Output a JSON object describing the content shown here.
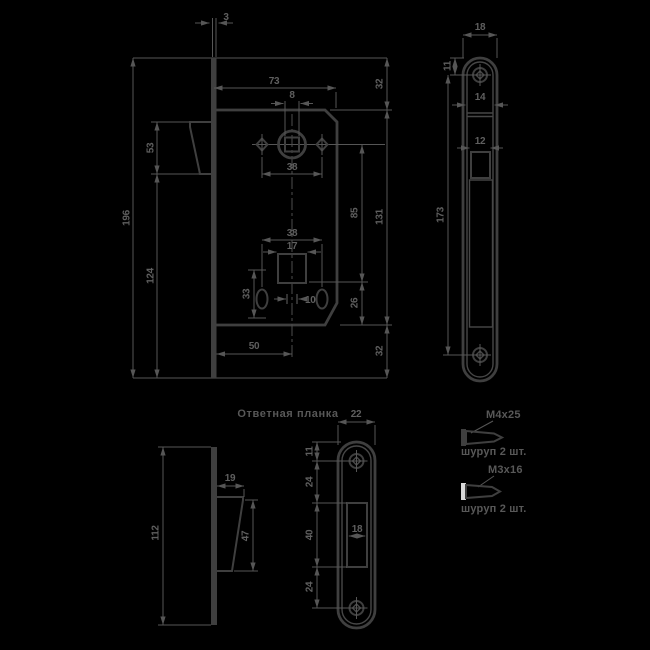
{
  "caption": {
    "strike_plate": "Ответная планка"
  },
  "dims": {
    "main": {
      "plate_thickness": "3",
      "case_width": "73",
      "plate_height": "196",
      "latch_height": "53",
      "below_latch": "124",
      "top_offset": "32",
      "case_height": "131",
      "bottom_offset": "32",
      "square_hole": "8",
      "handle_holes_span": "38",
      "axis_distance": "85",
      "key_bottom_offset": "26",
      "key_holes_span": "38",
      "keyway_width": "17",
      "keyhole_height": "33",
      "center_slot": "10",
      "backset": "50"
    },
    "faceplate": {
      "width": "18",
      "screw_top_offset": "11",
      "channel_width": "14",
      "latch_hole_width": "12",
      "screws_span": "173"
    },
    "strike": {
      "width": "22",
      "screw_top_offset": "11",
      "above_opening": "24",
      "opening_height": "40",
      "below_opening": "24",
      "opening_width": "18"
    },
    "side": {
      "height": "112",
      "latch_depth": "19",
      "latch_face_height": "47"
    }
  },
  "hardware": [
    {
      "spec": "М4х25",
      "qty": "шуруп 2 шт."
    },
    {
      "spec": "М3х16",
      "qty": "шуруп 2 шт."
    }
  ],
  "colors": {
    "background": "#000000",
    "outline": "#3f3f3f",
    "dim_lines": "#565656",
    "text": "#5f5f5f",
    "screw_head_highlight": "#d9d9d9"
  }
}
